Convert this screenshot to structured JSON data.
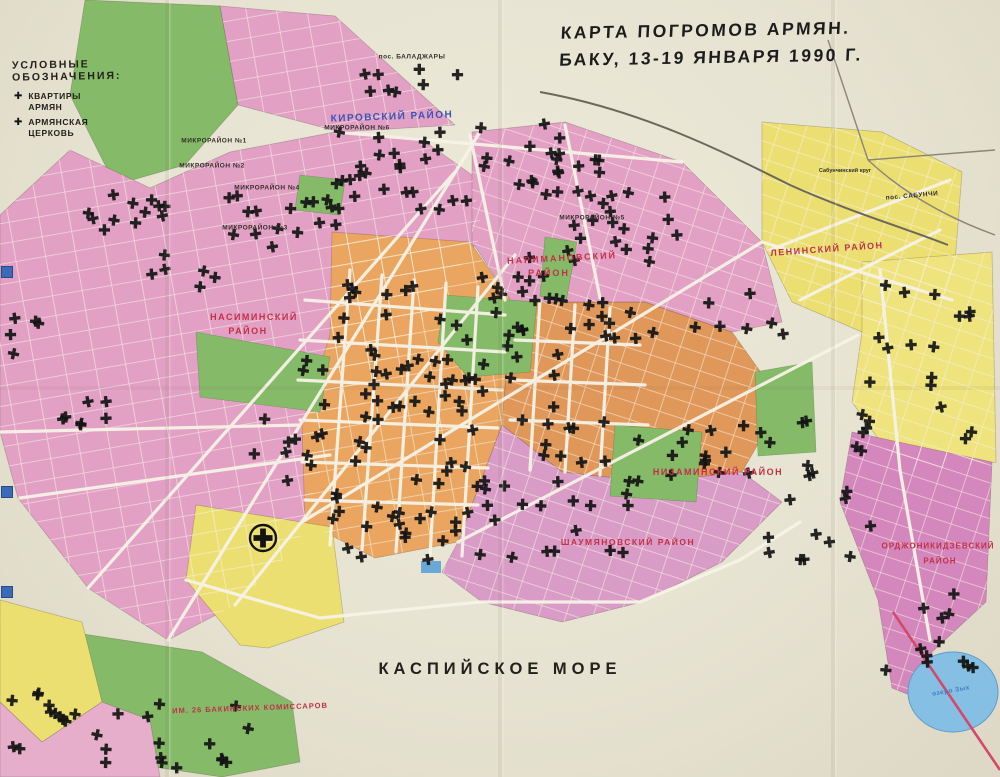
{
  "title": {
    "line1": "КАРТА ПОГРОМОВ АРМЯН.",
    "line2": "БАКУ, 13-19 ЯНВАРЯ 1990 Г."
  },
  "legend": {
    "heading": "УСЛОВНЫЕ  ОБОЗНАЧЕНИЯ:",
    "items": [
      {
        "symbol": "✚",
        "label": "КВАРТИРЫ\nАРМЯН"
      },
      {
        "symbol": "✚",
        "label": "АРМЯНСКАЯ\nЦЕРКОВЬ"
      }
    ]
  },
  "sea_label": "КАСПИЙСКОЕ МОРЕ",
  "labels": [
    {
      "t": "КИРОВСКИЙ РАЙОН",
      "x": 392,
      "y": 117,
      "c": "blue",
      "s": 10,
      "r": -2,
      "ls": 1.5
    },
    {
      "t": "МИКРОРАЙОН №6",
      "x": 357,
      "y": 128,
      "c": "dark",
      "s": 6.5,
      "r": 0,
      "ls": 0.5
    },
    {
      "t": "МИКРОРАЙОН №1",
      "x": 214,
      "y": 141,
      "c": "dark",
      "s": 6.5,
      "r": 0,
      "ls": 0.5
    },
    {
      "t": "МИКРОРАЙОН №2",
      "x": 212,
      "y": 166,
      "c": "dark",
      "s": 6.5,
      "r": 0,
      "ls": 0.5
    },
    {
      "t": "МИКРОРАЙОН №4",
      "x": 267,
      "y": 188,
      "c": "dark",
      "s": 6.5,
      "r": 0,
      "ls": 0.5
    },
    {
      "t": "МИКРОРАЙОН №3",
      "x": 255,
      "y": 228,
      "c": "dark",
      "s": 6.5,
      "r": 0,
      "ls": 0.5
    },
    {
      "t": "МИКРОРАЙОН №5",
      "x": 592,
      "y": 218,
      "c": "dark",
      "s": 6.5,
      "r": 0,
      "ls": 0.5
    },
    {
      "t": "НАРИМАНОВСКИЙ",
      "x": 562,
      "y": 258,
      "c": "red",
      "s": 9,
      "r": -3,
      "ls": 2
    },
    {
      "t": "РАЙОН",
      "x": 549,
      "y": 273,
      "c": "red",
      "s": 9,
      "r": 0,
      "ls": 2
    },
    {
      "t": "НАСИМИНСКИЙ",
      "x": 254,
      "y": 317,
      "c": "red",
      "s": 9,
      "r": 0,
      "ls": 1.5
    },
    {
      "t": "РАЙОН",
      "x": 248,
      "y": 331,
      "c": "red",
      "s": 9,
      "r": 0,
      "ls": 1.5
    },
    {
      "t": "НИЗАМИНСКИЙ РАЙОН",
      "x": 718,
      "y": 472,
      "c": "red",
      "s": 9,
      "r": 0,
      "ls": 1.5
    },
    {
      "t": "ШАУМЯНОВСКИЙ РАЙОН",
      "x": 628,
      "y": 542,
      "c": "red",
      "s": 8.5,
      "r": 0,
      "ls": 1.5
    },
    {
      "t": "ЛЕНИНСКИЙ РАЙОН",
      "x": 827,
      "y": 249,
      "c": "red",
      "s": 9,
      "r": -4,
      "ls": 1.5
    },
    {
      "t": "ОРДЖОНИКИДЗЕВСКИЙ",
      "x": 938,
      "y": 546,
      "c": "red",
      "s": 8,
      "r": 0,
      "ls": 1
    },
    {
      "t": "РАЙОН",
      "x": 940,
      "y": 561,
      "c": "red",
      "s": 8,
      "r": 0,
      "ls": 1
    },
    {
      "t": "ИМ. 26 БАКИНСКИХ КОМИССАРОВ",
      "x": 250,
      "y": 708,
      "c": "red",
      "s": 7.5,
      "r": -2,
      "ls": 1
    },
    {
      "t": "пос. САБУНЧИ",
      "x": 912,
      "y": 196,
      "c": "dark",
      "s": 6.5,
      "r": -5,
      "ls": 0.5
    },
    {
      "t": "Сабунчинский круг",
      "x": 845,
      "y": 171,
      "c": "dark",
      "s": 5.5,
      "r": 0,
      "ls": 0
    },
    {
      "t": "пос. БАЛАДЖАРЫ",
      "x": 412,
      "y": 57,
      "c": "dark",
      "s": 6.5,
      "r": 0,
      "ls": 0.5
    },
    {
      "t": "озеро Зых",
      "x": 951,
      "y": 691,
      "c": "lake",
      "s": 6.5,
      "r": -10,
      "ls": 0.5
    }
  ],
  "markers": {
    "cross_symbol": "✚",
    "church": {
      "x": 263,
      "y": 538
    },
    "clusters": [
      [
        88,
        192,
        95,
        45,
        12
      ],
      [
        225,
        195,
        110,
        55,
        12
      ],
      [
        335,
        110,
        150,
        100,
        26
      ],
      [
        350,
        60,
        120,
        45,
        8
      ],
      [
        470,
        120,
        100,
        75,
        12
      ],
      [
        555,
        185,
        130,
        80,
        22
      ],
      [
        335,
        280,
        150,
        145,
        42
      ],
      [
        490,
        280,
        130,
        100,
        20
      ],
      [
        250,
        360,
        80,
        160,
        14
      ],
      [
        330,
        430,
        185,
        130,
        38
      ],
      [
        520,
        400,
        120,
        160,
        26
      ],
      [
        645,
        420,
        115,
        60,
        12
      ],
      [
        755,
        415,
        120,
        145,
        20
      ],
      [
        862,
        280,
        115,
        160,
        20
      ],
      [
        880,
        580,
        95,
        95,
        12
      ],
      [
        10,
        690,
        110,
        80,
        16
      ],
      [
        125,
        700,
        135,
        70,
        12
      ],
      [
        55,
        375,
        90,
        50,
        7
      ],
      [
        0,
        300,
        60,
        60,
        5
      ],
      [
        480,
        250,
        80,
        55,
        8
      ],
      [
        695,
        290,
        105,
        45,
        7
      ],
      [
        590,
        300,
        65,
        45,
        6
      ],
      [
        135,
        247,
        80,
        40,
        6
      ],
      [
        300,
        195,
        40,
        40,
        5
      ],
      [
        545,
        125,
        60,
        50,
        6
      ]
    ]
  },
  "colors": {
    "paper": "#e8e4d4",
    "pink": "#e2a0c4",
    "pink_dark": "#d487bc",
    "orange": "#eaa660",
    "orange_dark": "#e0985a",
    "yellow": "#ecdf72",
    "green": "#85ba68",
    "water": "#86bfe4",
    "cross": "#141414",
    "road": "#f7f3e7",
    "label_red": "#c23048",
    "label_blue": "#3b55b4",
    "label_dark": "#33302a",
    "label_lake": "#3f7ec0"
  }
}
